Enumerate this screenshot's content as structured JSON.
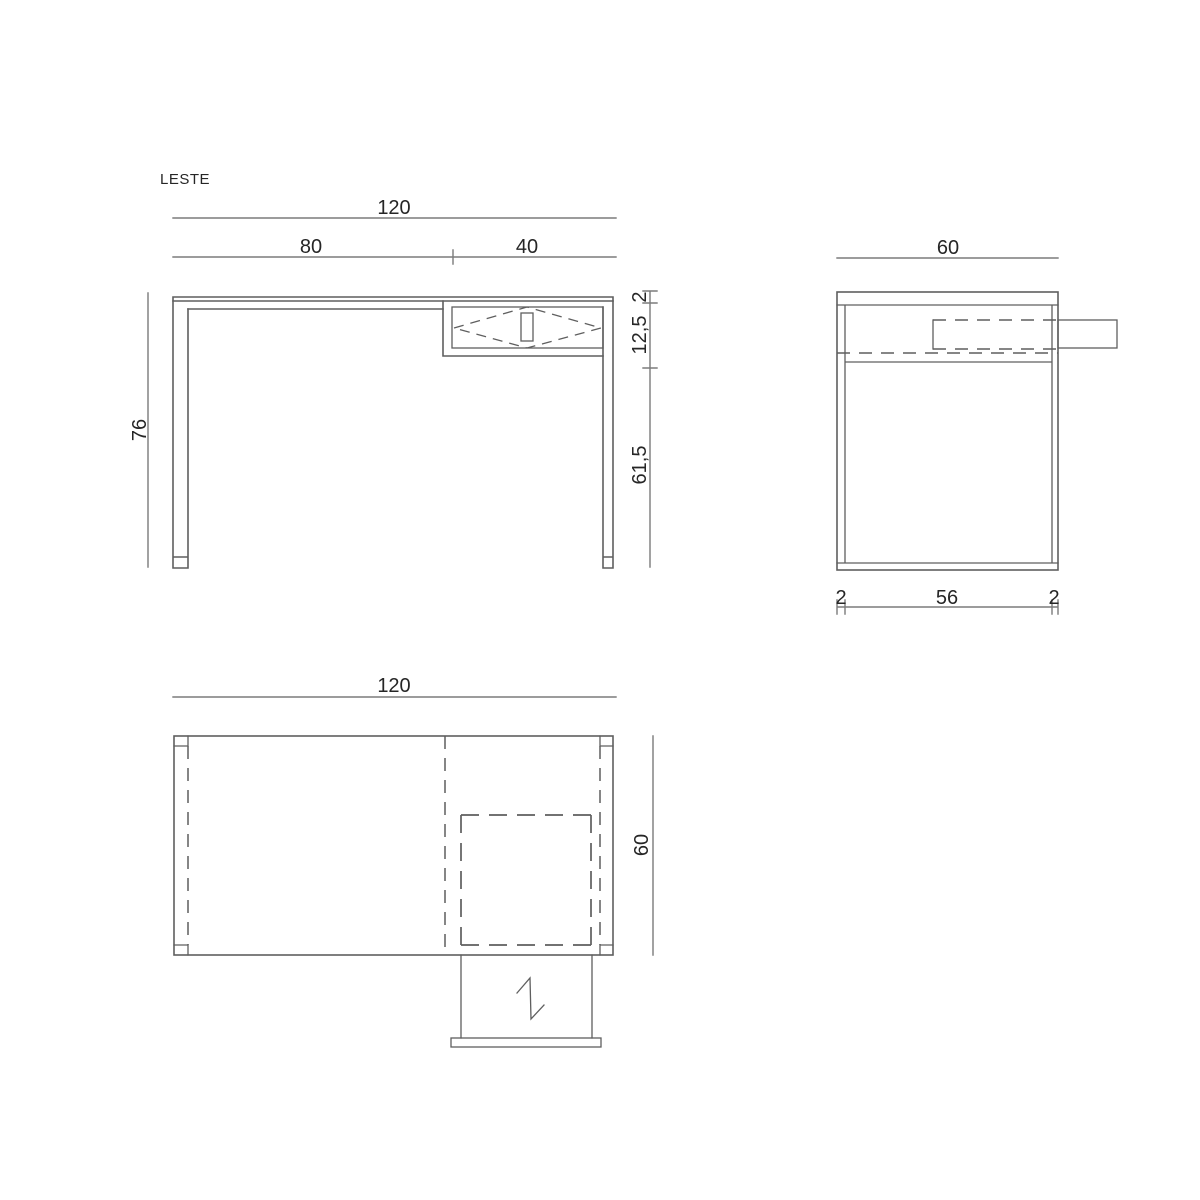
{
  "title": "LESTE",
  "colors": {
    "line": "#5f5f5f",
    "dim-line": "#7b7b7b",
    "text": "#262626",
    "background": "#ffffff"
  },
  "front_view": {
    "width_total": "120",
    "width_left": "80",
    "width_drawer": "40",
    "height_total": "76",
    "top_thickness": "2",
    "drawer_height": "12,5",
    "clearance_height": "61,5"
  },
  "side_view": {
    "depth_total": "60",
    "bottom_left": "2",
    "bottom_center": "56",
    "bottom_right": "2"
  },
  "plan_view": {
    "width_total": "120",
    "depth_total": "60"
  }
}
